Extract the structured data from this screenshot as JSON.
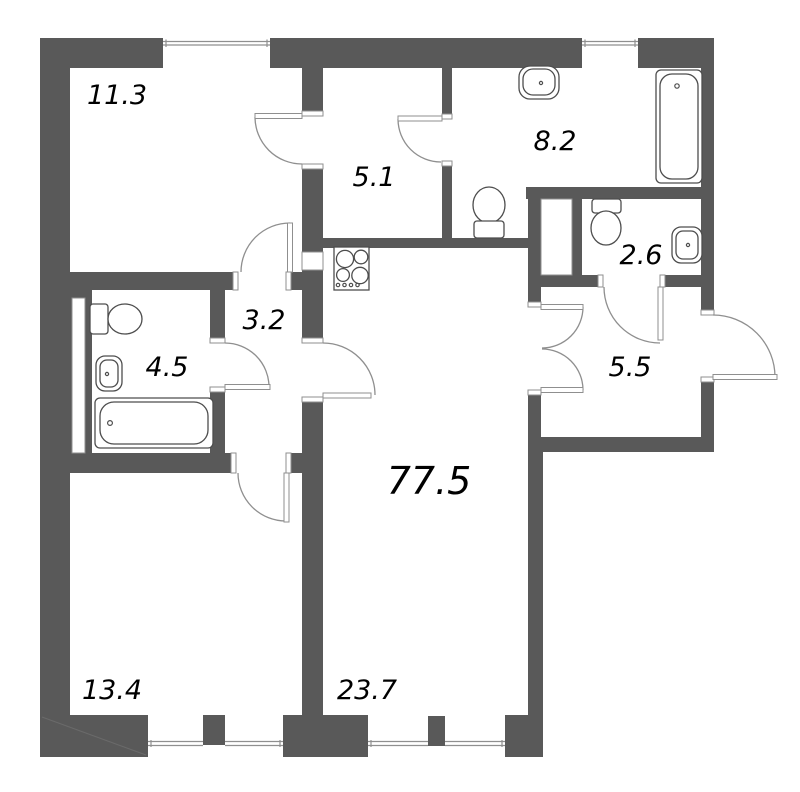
{
  "floor_plan": {
    "type": "apartment-floor-plan",
    "background_color": "#ffffff",
    "wall_color": "#595959",
    "line_color": "#8f8f8f",
    "text_color": "#000000",
    "rooms": [
      {
        "name": "bedroom-top-left",
        "area_label": "11.3"
      },
      {
        "name": "walkthrough-room",
        "area_label": "5.1"
      },
      {
        "name": "bathroom-large",
        "area_label": "8.2"
      },
      {
        "name": "wc-small",
        "area_label": "2.6"
      },
      {
        "name": "inner-hall",
        "area_label": "3.2"
      },
      {
        "name": "bathroom-small",
        "area_label": "4.5"
      },
      {
        "name": "entry-hall",
        "area_label": "5.5"
      },
      {
        "name": "total-area",
        "area_label": "77.5"
      },
      {
        "name": "room-bottom-left",
        "area_label": "13.4"
      },
      {
        "name": "kitchen-living",
        "area_label": "23.7"
      }
    ],
    "fixtures": [
      "toilet-icon",
      "sink-icon",
      "bathtub-icon",
      "stove-icon",
      "window-icon",
      "door-arc-icon"
    ]
  }
}
